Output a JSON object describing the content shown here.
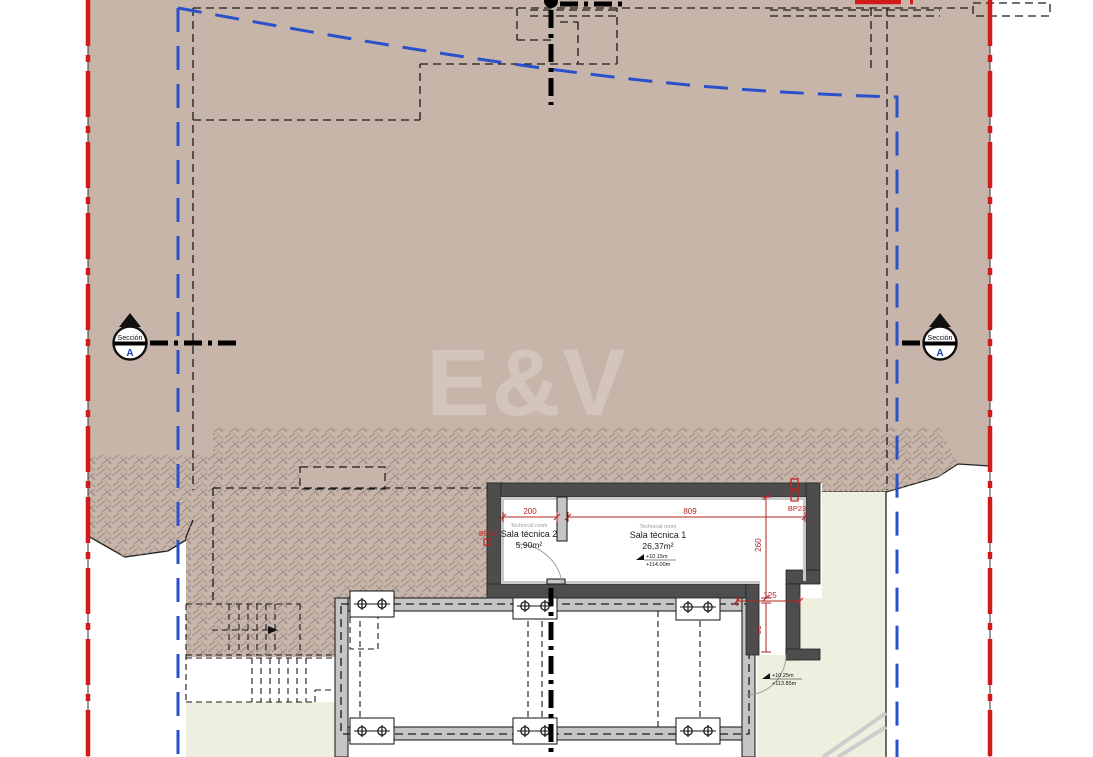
{
  "drawing": {
    "watermark": "E&V",
    "section_marker": {
      "title": "Sección",
      "letter": "A"
    },
    "rooms": [
      {
        "translation": "Technical room",
        "name": "Sala técnica 2",
        "area": "5,90m²"
      },
      {
        "translation": "Technical room",
        "name": "Sala técnica 1",
        "area": "26,37m²"
      }
    ],
    "dimensions": {
      "room2_width": "200",
      "room1_width": "809",
      "room_depth": "260",
      "passage_width": "125",
      "passage_depth": "81"
    },
    "drain_labels": {
      "left": "BP22",
      "right": "BP23"
    },
    "level_markers": [
      {
        "relative": "+10.15m",
        "absolute": "+114.00m"
      },
      {
        "relative": "+10.25m",
        "absolute": "+113.85m"
      }
    ],
    "colors": {
      "terrain": "#c8b5aa",
      "hatch": "#9b8a80",
      "green": "#edf0de",
      "boundary_red": "#d31a1a",
      "plot_blue": "#2b50cb",
      "dim_red": "#b32424",
      "wall_dark": "#4d4d4d",
      "wall_light": "#c5c5c5",
      "watermark_color": "#d4c5bc"
    }
  }
}
